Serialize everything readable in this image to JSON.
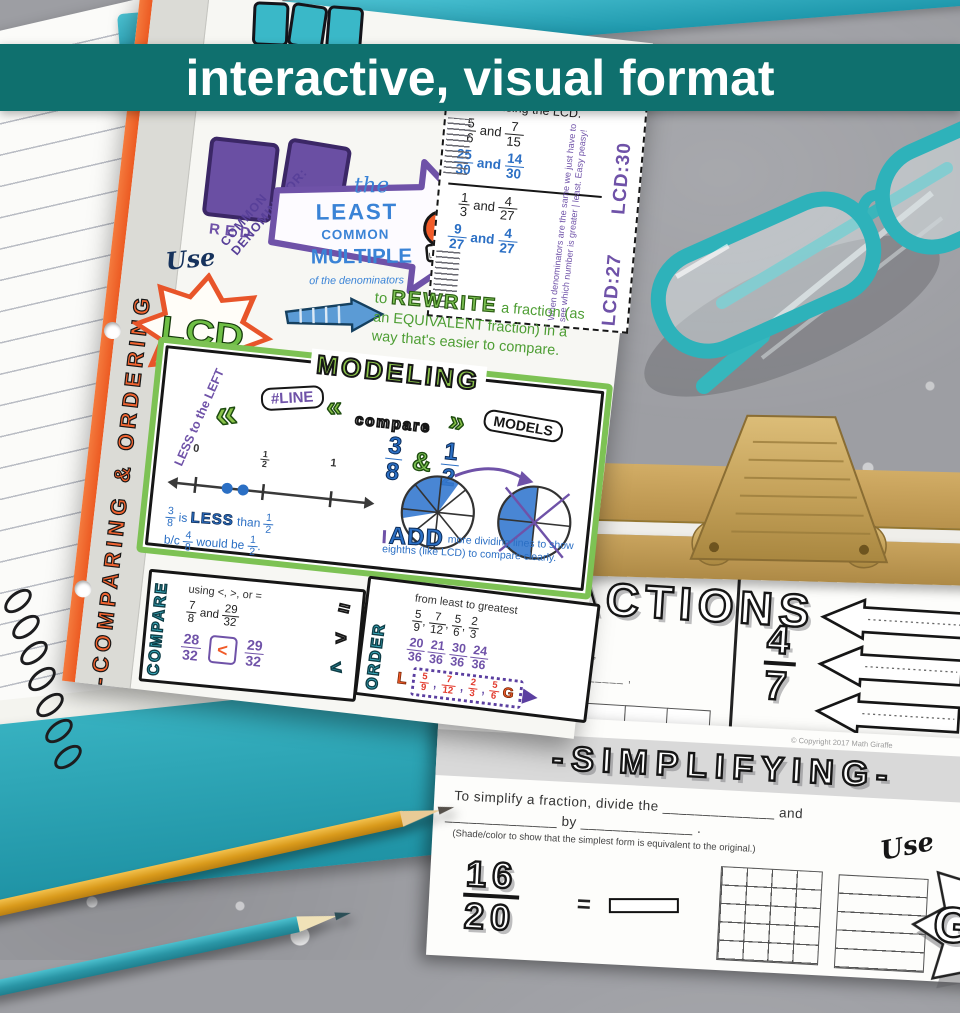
{
  "banner": {
    "text": "interactive, visual format"
  },
  "comma": ",",
  "page": {
    "side_title": "-COMPARING & ORDERING",
    "red_label": "RED",
    "common_denominator": "COMMON DENOMINATOR:",
    "use_label": "Use",
    "burst_label": "LCD",
    "glove_label": "LCM",
    "arrow": {
      "the": "the",
      "least": "LEAST",
      "common": "COMMON",
      "multiple": "MULTIPLE",
      "of": "of the denominators"
    },
    "rewrite_box": {
      "title": "Rewrite using the LCD.",
      "and": "and",
      "p1": {
        "given_a": "5/6",
        "given_b": "7/15",
        "ans_a": "25/30",
        "ans_b": "14/30",
        "lcd": "LCD:30"
      },
      "p2": {
        "given_a": "1/3",
        "given_b": "4/27",
        "ans_a": "9/27",
        "ans_b": "4/27",
        "lcd": "LCD:27"
      },
      "margin_note": "When denominators are the same we just have to see which number is greater | least. Easy peasy!"
    },
    "rewrite_text": {
      "to": "to",
      "rewrite": "REWRITE",
      "rest": "a fraction (as an EQUIVALENT fraction) in a way that's easier to compare."
    },
    "modeling": {
      "title": "MODELING",
      "less_note": "LESS to the LEFT",
      "line_tag": "#LINE",
      "chevron": "«",
      "chevron_r": "»",
      "compare_word": "compare",
      "models_word": "MODELS",
      "frac_a": "3/8",
      "amp": "&",
      "frac_b": "1/2",
      "ticks": [
        "0",
        "1/2",
        "1"
      ],
      "reason_a": "3/8",
      "reason_is": "is",
      "reason_less": "LESS",
      "reason_than": "than",
      "reason_half": "1/2",
      "reason_b1": "b/c",
      "reason_b2": "4/8",
      "reason_b3": "would be",
      "reason_b4": "1/2",
      "period": ".",
      "add_word": "ADD",
      "add_text": "more dividing lines to show eighths (like LCD) to compare clearly."
    },
    "compare_box": {
      "label": "COMPARE",
      "instruction": "using <, >, or =",
      "given_a": "7/8",
      "and": "and",
      "given_b": "29/32",
      "ans_left": "28/32",
      "ans_sym": "<",
      "ans_right": "29/32",
      "doodle_eq": "=",
      "doodle_gt": ">",
      "doodle_lt": "<"
    },
    "order_box": {
      "label": "ORDER",
      "instruction": "from least to greatest",
      "given": [
        "5/9",
        "7/12",
        "5/6",
        "2/3"
      ],
      "converted": [
        "20/36",
        "21/36",
        "30/36",
        "24/36"
      ],
      "l": "L",
      "answer": [
        "5/9",
        "7/12",
        "2/3",
        "5/6"
      ],
      "g": "G"
    }
  },
  "sheets": {
    "fractions": {
      "title": "FRACTIONS",
      "partial_lines": [
        "...ts ________",
        "________  <  ________ ,",
        "...tion, ________  <  ________ ,",
        "(...w the fraction 4/7.)"
      ],
      "fraction": "4/7",
      "copyright": "© Copyright 2017 Math Giraffe"
    },
    "simplifying": {
      "title": "-SIMPLIFYING-",
      "line1": "To simplify a fraction, divide the ______________ and",
      "line2": "______________ by ______________ .",
      "note": "(Shade/color to show that the simplest form is equivalent to the original.)",
      "fraction": "16/20",
      "equals": "=",
      "use_label": "Use",
      "gcf": "GCF",
      "copyright": "© Copyright 2017 Math Giraffe"
    }
  },
  "colors": {
    "banner": "#0f706e",
    "orange": "#f05a28",
    "purple": "#6f52a8",
    "blue": "#2b6fc4",
    "green": "#7dc254",
    "teal": "#38b6c6",
    "gold": "#c7a35f"
  }
}
